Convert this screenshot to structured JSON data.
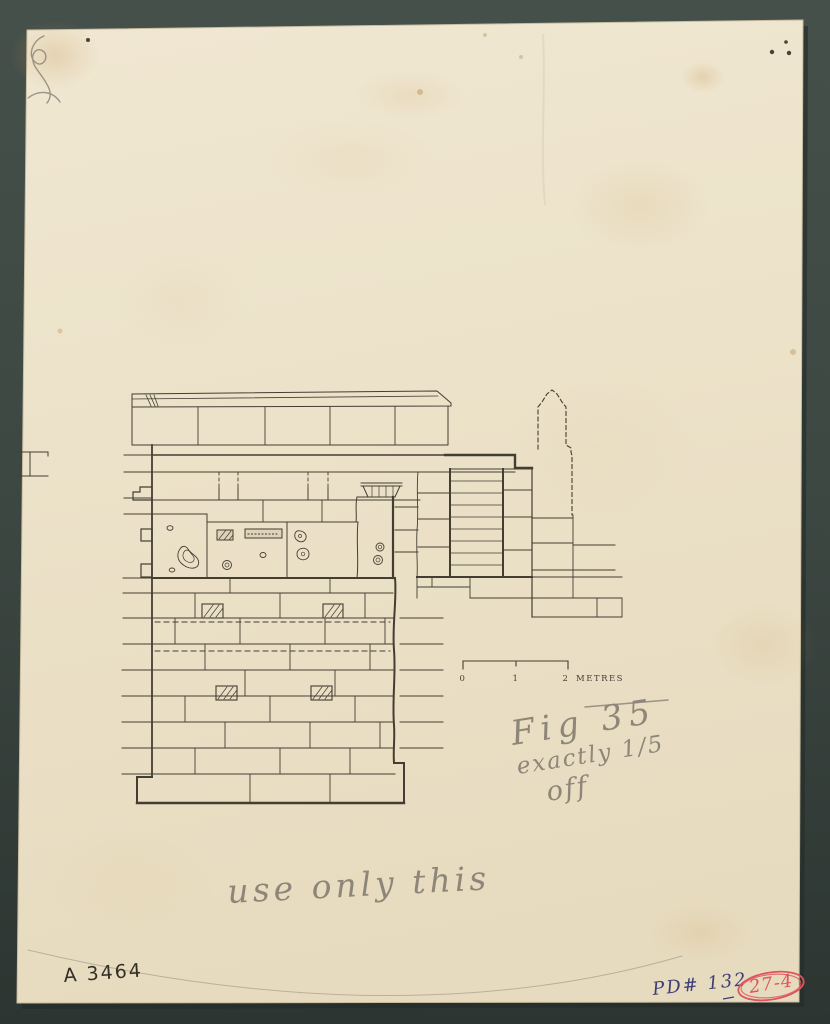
{
  "colors": {
    "background": "#3d4742",
    "paper": "#ece3cc",
    "ink": "#443e32",
    "ink_dark": "#332e26",
    "pencil": "#8d8679",
    "blue_ink": "#3e3e74",
    "red_ink": "#dd545c"
  },
  "scale_bar": {
    "tick_0": "0",
    "tick_1": "1",
    "tick_2": "2",
    "unit": "METRES"
  },
  "annotations": {
    "figure_note_line_1": "Fig 35",
    "figure_note_line_2": "exactly 1/5",
    "figure_note_line_3": "off",
    "usage_note": "use only this",
    "catalog_number": "A 3464",
    "inventory_number": "PD# 132",
    "circled_number": "27-4"
  }
}
